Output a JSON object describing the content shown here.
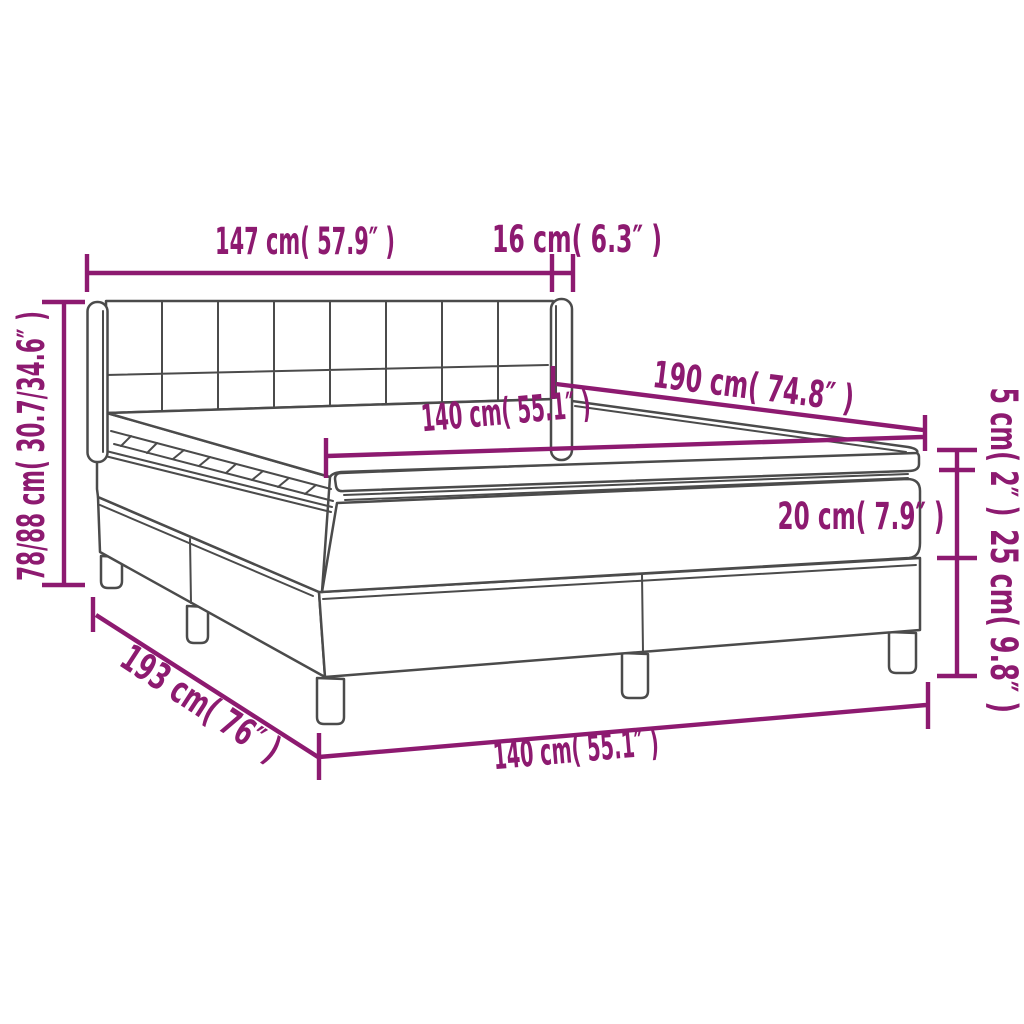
{
  "diagram": {
    "title": "Box spring bed with mattress — dimension diagram",
    "colors": {
      "dimension": "#8d1a70",
      "outline": "#4b4b4b",
      "background": "#ffffff"
    },
    "dimensions": [
      {
        "id": "headboard-width",
        "label": "147 cm( 57.9″ )",
        "cm": "147",
        "inch": "57.9"
      },
      {
        "id": "headboard-wing-depth",
        "label": "16 cm( 6.3″ )",
        "cm": "16",
        "inch": "6.3"
      },
      {
        "id": "headboard-height",
        "label": "78/88 cm( 30.7/34.6″ )",
        "cm": "78/88",
        "inch": "30.7/34.6"
      },
      {
        "id": "bed-length",
        "label": "190 cm( 74.8″ )",
        "cm": "190",
        "inch": "74.8"
      },
      {
        "id": "mattress-width",
        "label": "140 cm( 55.1″ )",
        "cm": "140",
        "inch": "55.1"
      },
      {
        "id": "topper-height",
        "label": "5 cm( 2″ )",
        "cm": "5",
        "inch": "2"
      },
      {
        "id": "mattress-height",
        "label": "20 cm( 7.9″ )",
        "cm": "20",
        "inch": "7.9"
      },
      {
        "id": "base-height",
        "label": "25 cm( 9.8″ )",
        "cm": "25",
        "inch": "9.8"
      },
      {
        "id": "base-length",
        "label": "193 cm( 76″ )",
        "cm": "193",
        "inch": "76"
      },
      {
        "id": "base-width",
        "label": "140 cm( 55.1″ )",
        "cm": "140",
        "inch": "55.1"
      }
    ]
  }
}
